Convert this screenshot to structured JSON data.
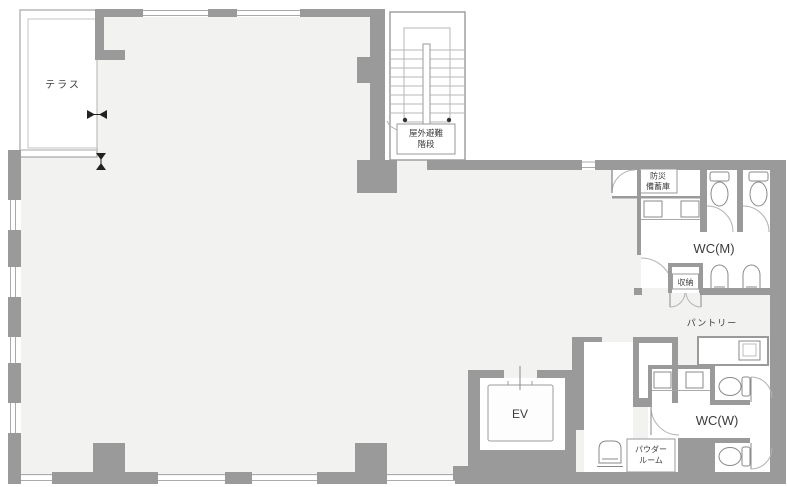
{
  "colors": {
    "wall": "#9a9a9a",
    "floor": "#f2f2f1",
    "room_white": "#ffffff",
    "line": "#a8a8a8",
    "text": "#3c3c3c"
  },
  "rooms": {
    "terrace": {
      "label": "テラス"
    },
    "stairs": {
      "label_line1": "屋外避難",
      "label_line2": "階段"
    },
    "disaster_storage": {
      "label_line1": "防災",
      "label_line2": "備蓄庫"
    },
    "wc_men": {
      "label": "WC(M)"
    },
    "storage": {
      "label": "収納"
    },
    "pantry": {
      "label": "パントリー"
    },
    "elevator": {
      "label": "EV"
    },
    "powder_room": {
      "label_line1": "パウダー",
      "label_line2": "ルーム"
    },
    "wc_women": {
      "label": "WC(W)"
    }
  }
}
